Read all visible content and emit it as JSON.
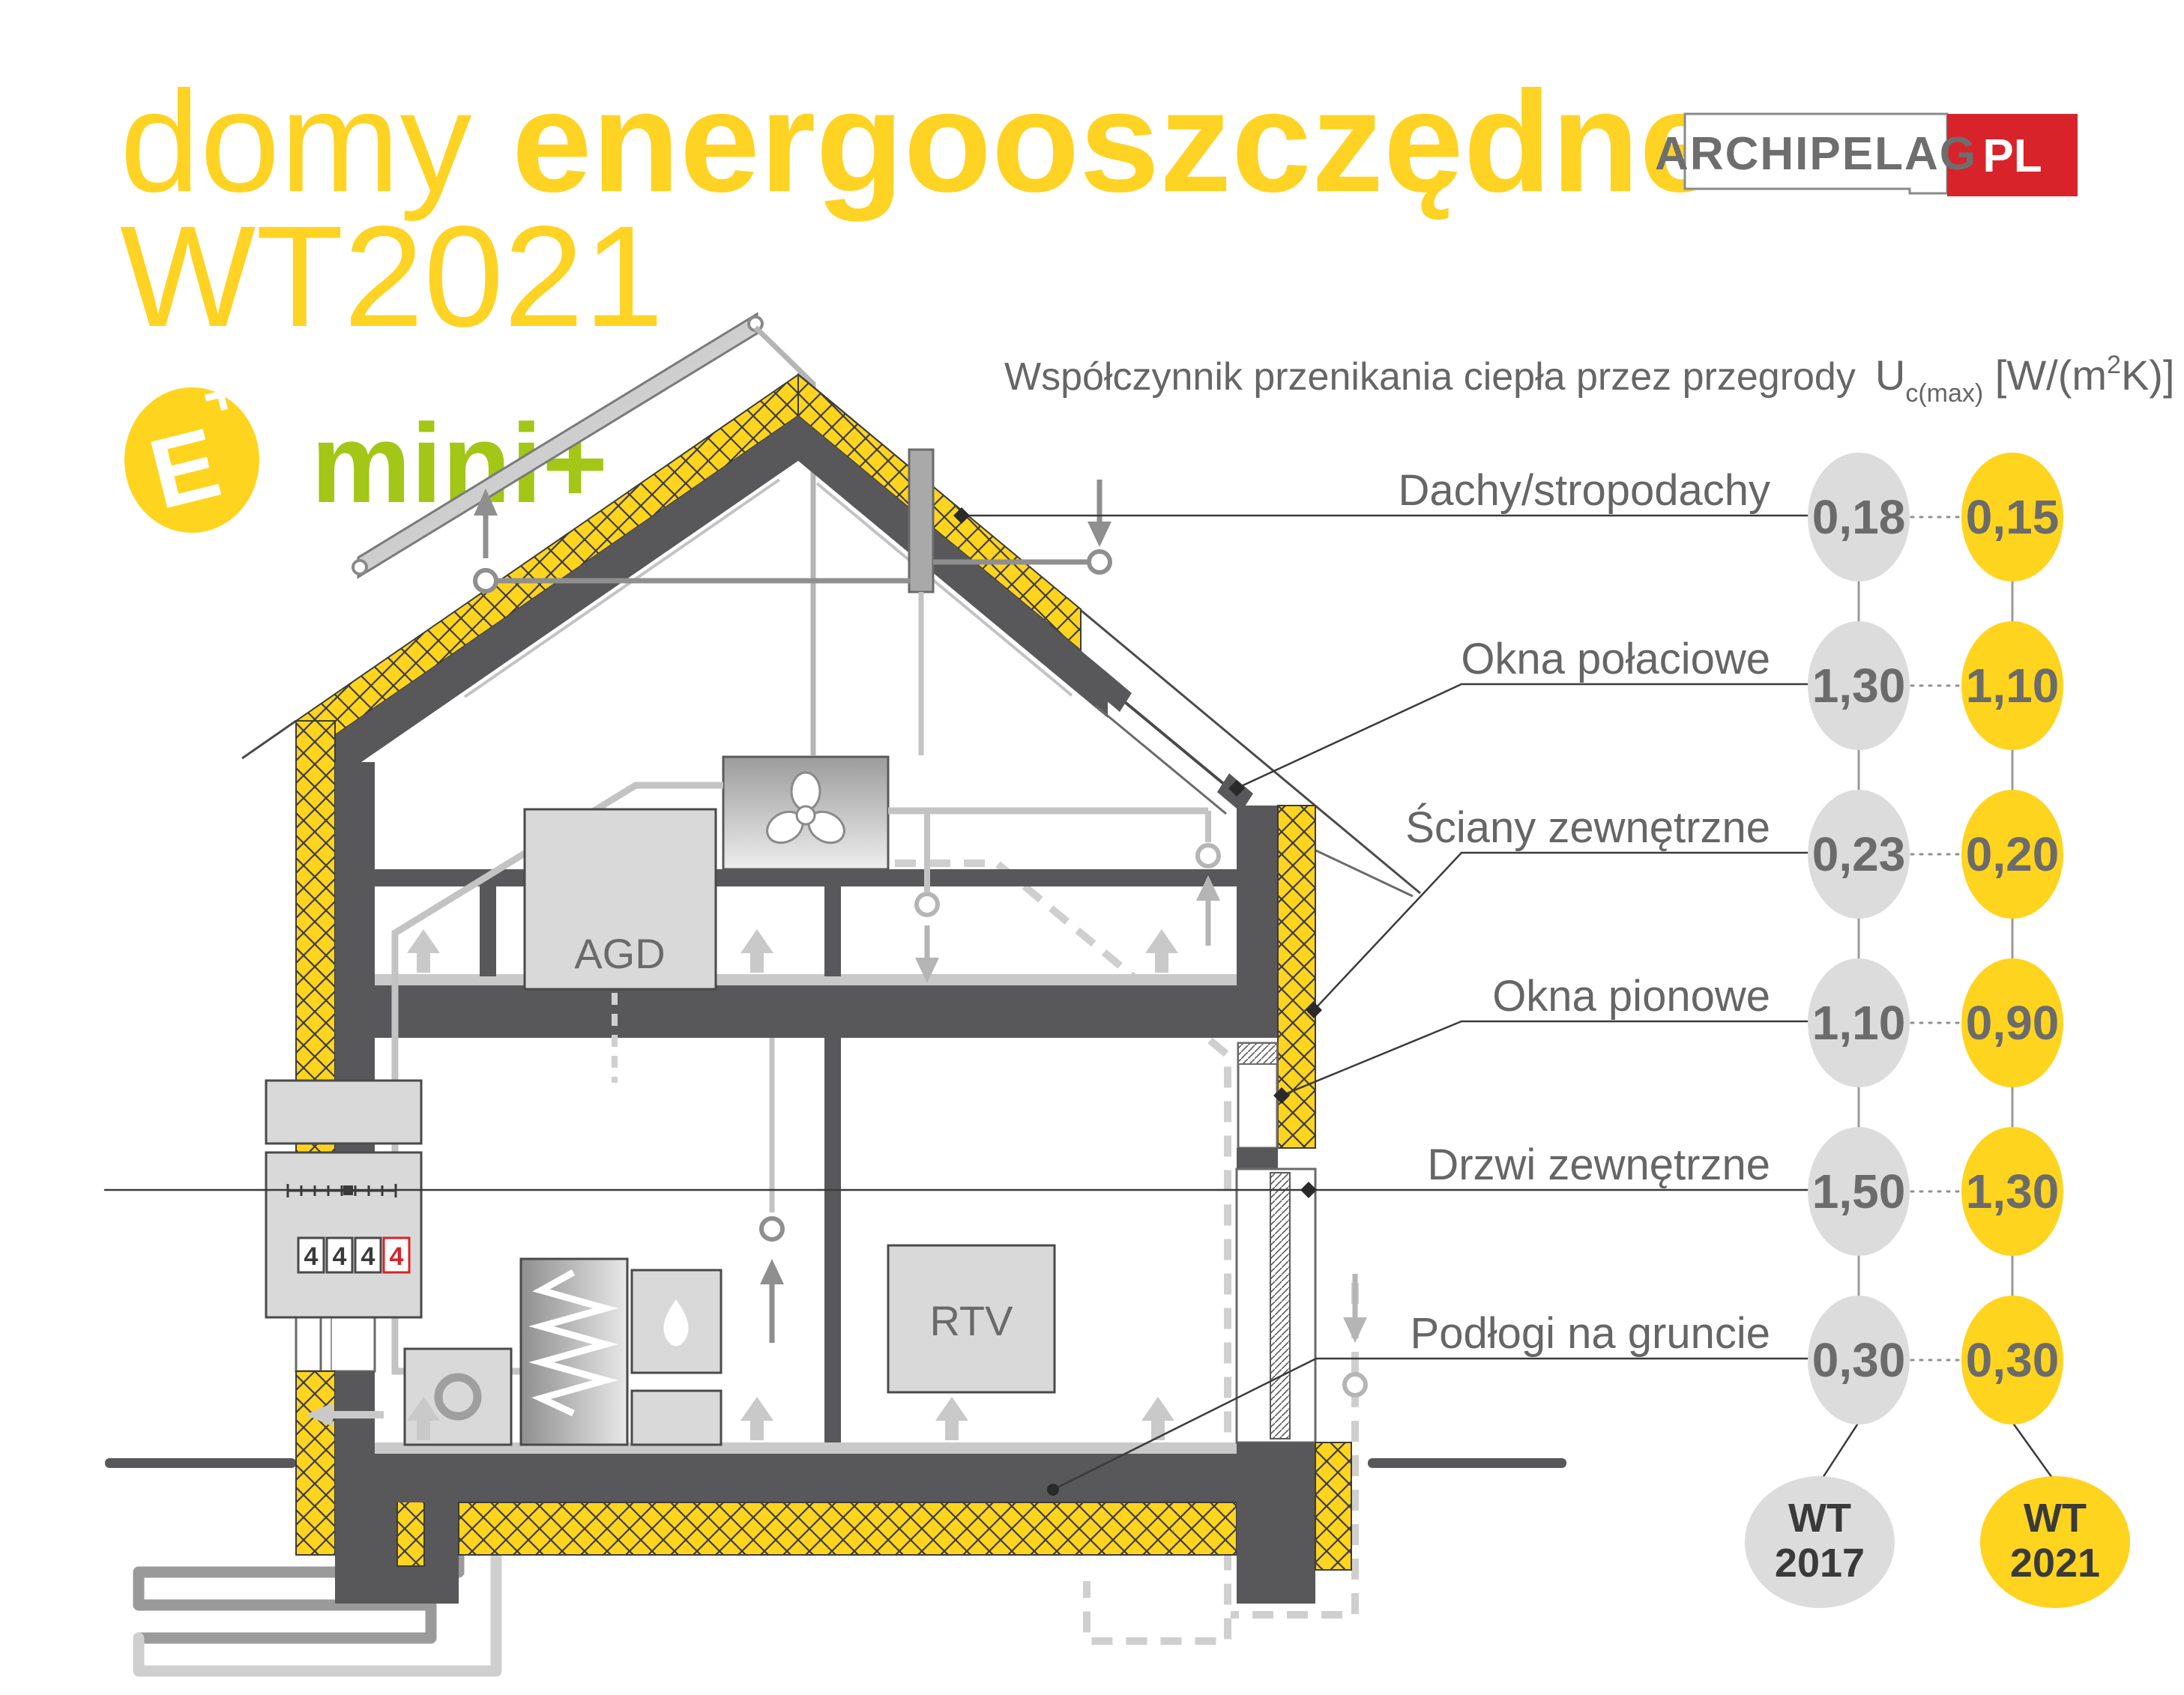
{
  "title": {
    "part1": "domy ",
    "part2": "energooszczędne",
    "line2": "WT2021"
  },
  "logo": {
    "name": "ARCHIPELAG",
    "tld": "PL"
  },
  "badge": {
    "e": "E",
    "plus": "+",
    "label": "mini+"
  },
  "header": {
    "label": "Współczynnik przenikania ciepła przez przegrody",
    "u": "U",
    "u_sub": "c(max)",
    "unit_open": " [W/(m",
    "unit_sup": "2",
    "unit_close": "K)]"
  },
  "table": {
    "rows": [
      {
        "label": "Dachy/stropodachy",
        "wt2017": "0,18",
        "wt2021": "0,15"
      },
      {
        "label": "Okna połaciowe",
        "wt2017": "1,30",
        "wt2021": "1,10"
      },
      {
        "label": "Ściany zewnętrzne",
        "wt2017": "0,23",
        "wt2021": "0,20"
      },
      {
        "label": "Okna pionowe",
        "wt2017": "1,10",
        "wt2021": "0,90"
      },
      {
        "label": "Drzwi zewnętrzne",
        "wt2017": "1,50",
        "wt2021": "1,30"
      },
      {
        "label": "Podłogi na gruncie",
        "wt2017": "0,30",
        "wt2021": "0,30"
      }
    ],
    "columns": {
      "wt2017_l1": "WT",
      "wt2017_l2": "2017",
      "wt2021_l1": "WT",
      "wt2021_l2": "2021"
    }
  },
  "house": {
    "agd": "AGD",
    "rtv": "RTV",
    "meter_digits": [
      "4",
      "4",
      "4",
      "4"
    ]
  },
  "colors": {
    "accent_yellow": "#ffd41f",
    "title_yellow": "#ffd323",
    "lime_green": "#a3c617",
    "brand_red": "#d8232a",
    "structure_gray": "#58585a",
    "circle_gray": "#dcdcdc",
    "text_gray": "#666666"
  }
}
